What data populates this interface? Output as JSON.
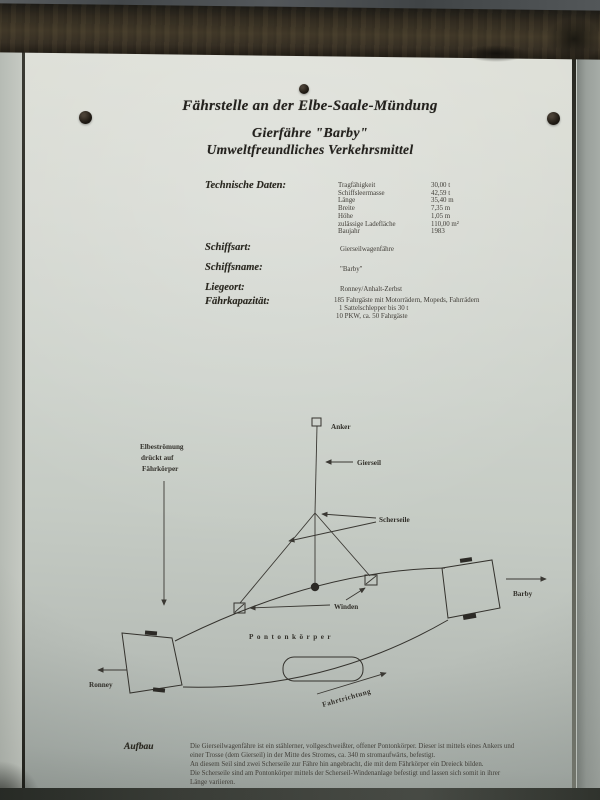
{
  "sign": {
    "title_line1": "Fährstelle an der Elbe-Saale-Mündung",
    "title_line2": "Gierfähre \"Barby\"",
    "title_line3": "Umweltfreundliches Verkehrsmittel",
    "technical": {
      "heading": "Technische Daten:",
      "rows": [
        {
          "label": "Tragfähigkeit",
          "value": "30,00 t"
        },
        {
          "label": "Schiffsleermasse",
          "value": "42,59 t"
        },
        {
          "label": "Länge",
          "value": "35,40 m"
        },
        {
          "label": "Breite",
          "value": "7,35 m"
        },
        {
          "label": "Höhe",
          "value": "1,05 m"
        },
        {
          "label": "zulässige Ladefläche",
          "value": "110,00 m²"
        },
        {
          "label": "Baujahr",
          "value": "1983"
        }
      ]
    },
    "details": [
      {
        "label": "Schiffsart:",
        "value": "Gierseilwagenfähre"
      },
      {
        "label": "Schiffsname:",
        "value": "\"Barby\""
      },
      {
        "label": "Liegeort:",
        "value": "Ronney/Anhalt-Zerbst"
      }
    ],
    "capacity": {
      "label": "Fährkapazität:",
      "lines": [
        "185 Fahrgäste mit Motorrädern, Mopeds, Fahrrädern",
        "1 Sattelschlepper bis 30 t",
        "10 PKW, ca. 50 Fahrgäste"
      ]
    },
    "diagram": {
      "labels": {
        "anker": "Anker",
        "gierseil": "Gierseil",
        "scherseile": "Scherseile",
        "winden": "Winden",
        "pontonkoerper": "Pontonkörper",
        "fahrtrichtung": "Fahrtrichtung",
        "ronney": "Ronney",
        "barby": "Barby",
        "stroemung_l1": "Elbeströmung",
        "stroemung_l2": "drückt auf",
        "stroemung_l3": "Fährkörper"
      }
    },
    "aufbau": {
      "heading": "Aufbau",
      "lines": [
        "Die Gierseilwagenfähre ist ein stählerner, vollgeschweißter, offener Pontonkörper. Dieser ist mittels eines Ankers und",
        "einer Trosse (dem Gierseil) in der Mitte des Stromes, ca. 340 m stromaufwärts, befestigt.",
        "An diesem Seil sind zwei Scherseile zur Fähre hin angebracht, die mit dem Fährkörper ein Dreieck bilden.",
        "Die Scherseile sind am Pontonkörper mittels der Scherseil-Windenanlage befestigt und lassen sich somit in ihrer",
        "Länge variieren."
      ]
    }
  },
  "colors": {
    "sign_paper": "#d5d8d1",
    "ink": "#33312b",
    "beam_wood": "#3a3226",
    "wall": "#9aa09b"
  }
}
